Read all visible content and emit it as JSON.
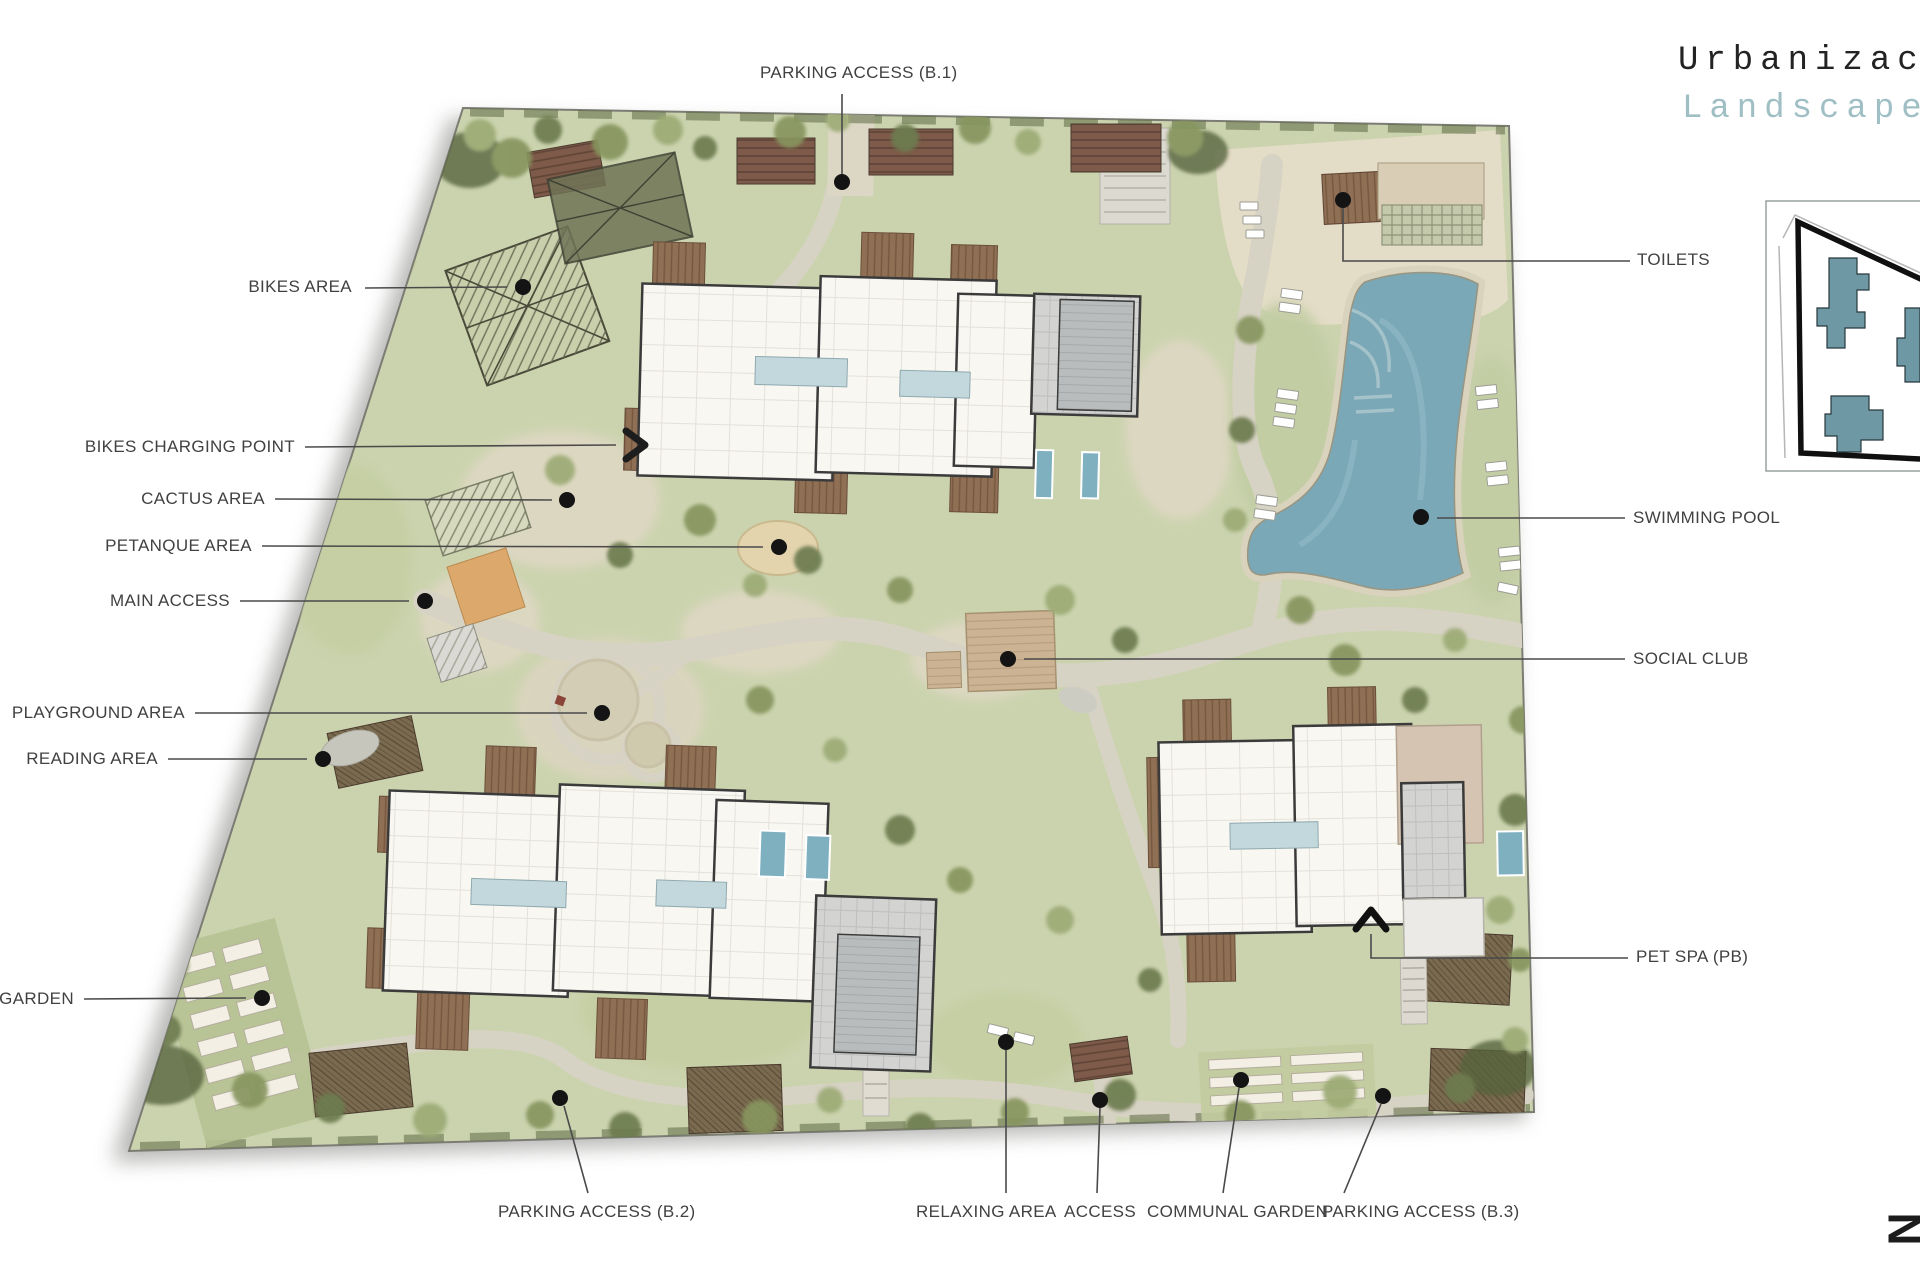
{
  "title": {
    "line1": "Urbanizac",
    "line2": "Landscape"
  },
  "plan_labels": {
    "parking_access_b1": "PARKING ACCESS (B.1)",
    "bikes_area": "BIKES AREA",
    "bikes_charging_point": "BIKES CHARGING POINT",
    "cactus_area": "CACTUS AREA",
    "petanque_area": "PETANQUE AREA",
    "main_access": "MAIN ACCESS",
    "playground_area": "PLAYGROUND AREA",
    "reading_area": "READING AREA",
    "garden_clipped": "L GARDEN",
    "parking_access_b2": "PARKING ACCESS (B.2)",
    "relaxing_area": "RELAXING AREA",
    "access": "ACCESS",
    "communal_garden": "COMMUNAL GARDEN",
    "parking_access_b3": "PARKING ACCESS (B.3)",
    "toilets": "TOILETS",
    "swimming_pool": "SWIMMING POOL",
    "social_club": "SOCIAL CLUB",
    "pet_spa": "PET SPA (PB)"
  },
  "north_marker": "N",
  "colors": {
    "title_text": "#232323",
    "subtitle_teal": "#9fbfc4",
    "label_text": "#414141",
    "site_green": "#cbd3ae",
    "pool_blue": "#7aa8b6",
    "path_beige": "#d7d3c4",
    "building_white": "#f8f7f2",
    "roof_gray": "#d1d1cf",
    "terrace_brown": "#8f7055",
    "keyplan_building": "#6f98a5"
  }
}
